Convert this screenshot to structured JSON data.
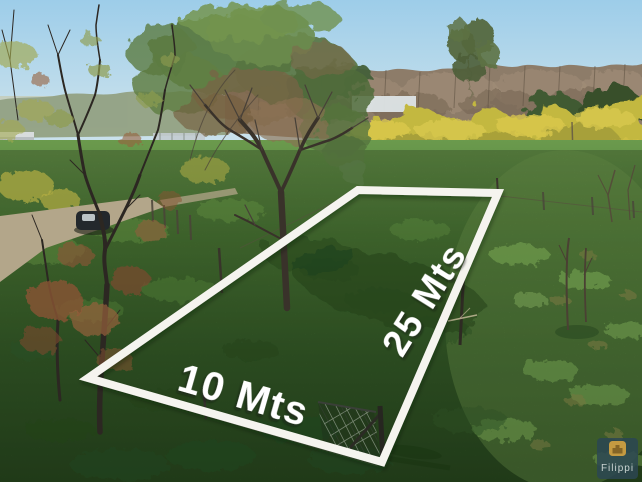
{
  "plot_overlay": {
    "width_label": "10 Mts",
    "depth_label": "25 Mts",
    "outline_color": "#f5f4ef"
  },
  "watermark": {
    "brand_name": "Filippi",
    "logo_icon": "building-logo-icon",
    "panel_color": "#2c4752",
    "icon_color": "#c49a41",
    "icon_glyph_color": "#7a5c22",
    "text_color": "#c9d3d1"
  },
  "palette": {
    "sky_top": "#9dcde9",
    "sky_horizon": "#c9e1ec",
    "yellow_field": "#c3b83f",
    "grass_light": "#6f9e4e",
    "grass_dark": "#2a4b20"
  }
}
